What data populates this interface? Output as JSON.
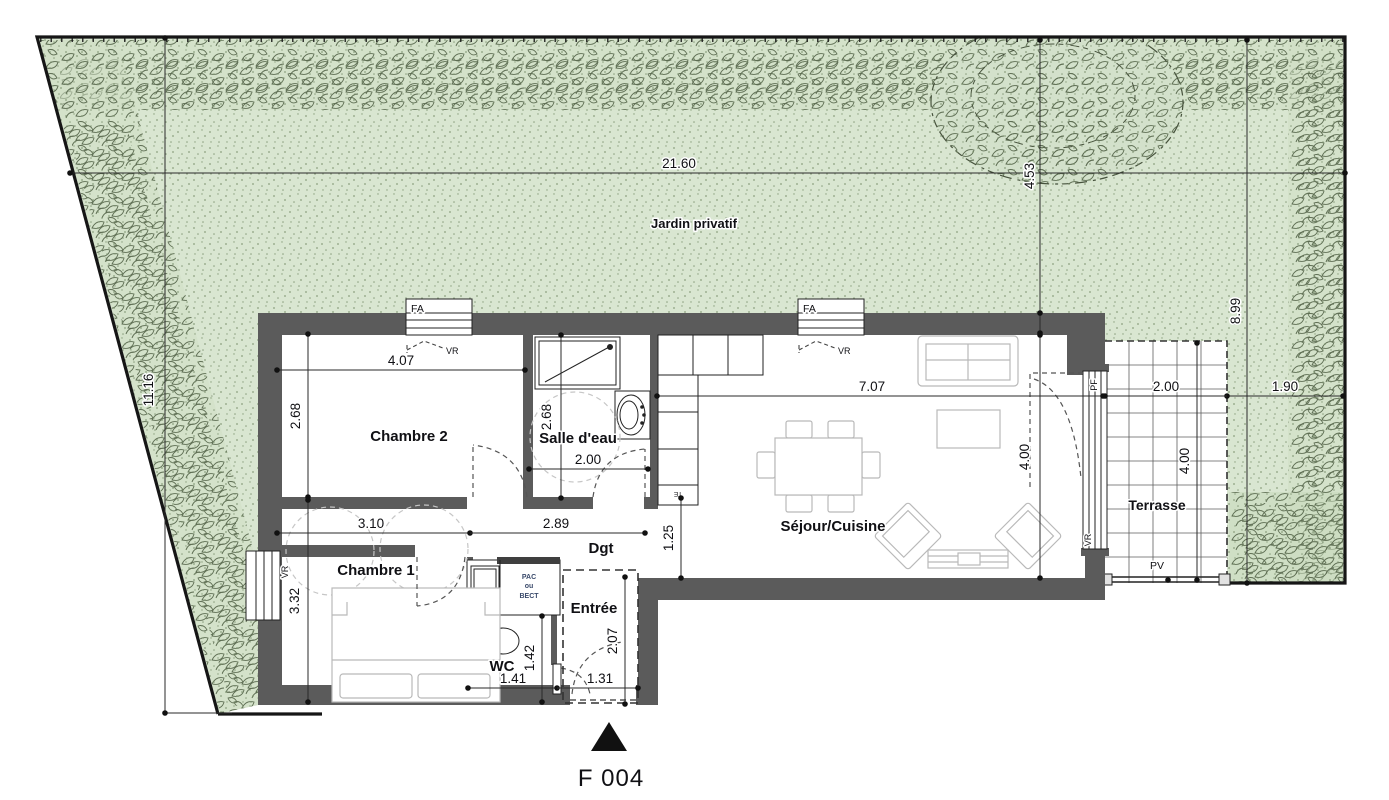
{
  "title": "F 004",
  "garden": {
    "label": "Jardin privatif"
  },
  "rooms": {
    "chambre2": {
      "label": "Chambre 2"
    },
    "salle_deau": {
      "label": "Salle d'eau"
    },
    "chambre1": {
      "label": "Chambre 1"
    },
    "wc": {
      "label": "WC"
    },
    "entree": {
      "label": "Entrée"
    },
    "dgt": {
      "label": "Dgt"
    },
    "sejour": {
      "label": "Séjour/Cuisine"
    },
    "terrasse": {
      "label": "Terrasse"
    }
  },
  "dims": {
    "site_width": "21.60",
    "site_left": "11.16",
    "site_right": "8.99",
    "tree_axis": "4.53",
    "boundary_gap": "1.90",
    "terrasse_width": "2.00",
    "terrasse_depth": "4.00",
    "sejour_width": "7.07",
    "sejour_depth": "4.00",
    "chambre2_width": "4.07",
    "chambre2_depth": "2.68",
    "salle_deau_width": "2.00",
    "salle_deau_depth": "2.68",
    "dgt_left": "3.10",
    "dgt_right": "2.89",
    "dgt_passage": "1.25",
    "chambre1_depth": "3.32",
    "wc_width": "1.41",
    "wc_depth": "1.42",
    "entree_width": "1.31",
    "entree_depth": "2.07"
  },
  "tags": {
    "fa": "FA",
    "vr": "VR",
    "pf": "PF",
    "pv": "PV",
    "te": "TE",
    "pac": {
      "l1": "PAC",
      "l2": "ou",
      "l3": "BECT"
    }
  },
  "colors": {
    "wall": "#5b5b5b",
    "garden_fill": "#d9e6d1",
    "boundary": "#161616",
    "foliage": "#5e6e53",
    "furniture": "#b9b9b9"
  }
}
